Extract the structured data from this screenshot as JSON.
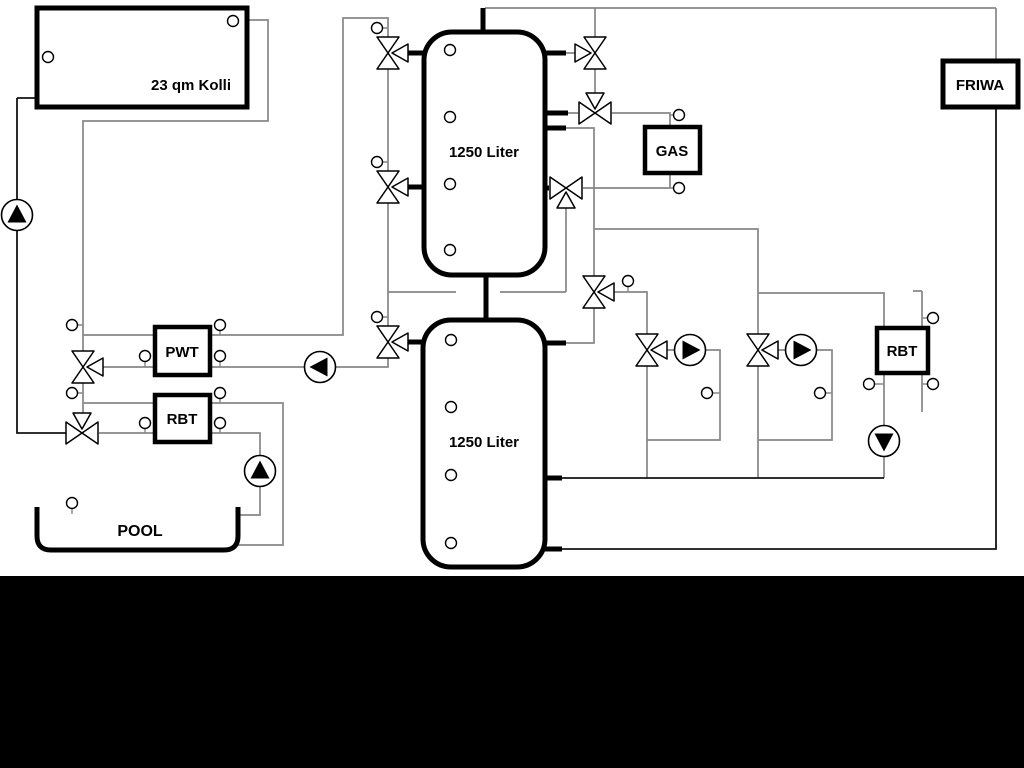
{
  "diagram": {
    "labels": {
      "collector": "23 qm Kolli",
      "tank_upper": "1250 Liter",
      "tank_lower": "1250 Liter",
      "gas": "GAS",
      "friwa": "FRIWA",
      "pwt": "PWT",
      "rbt_left": "RBT",
      "rbt_right": "RBT",
      "pool": "POOL"
    },
    "colors": {
      "pipe_gray": "#878787",
      "pipe_dark": "#141414",
      "component_outline": "#000000",
      "background": "#ffffff",
      "bottom_bar": "#000000"
    }
  }
}
